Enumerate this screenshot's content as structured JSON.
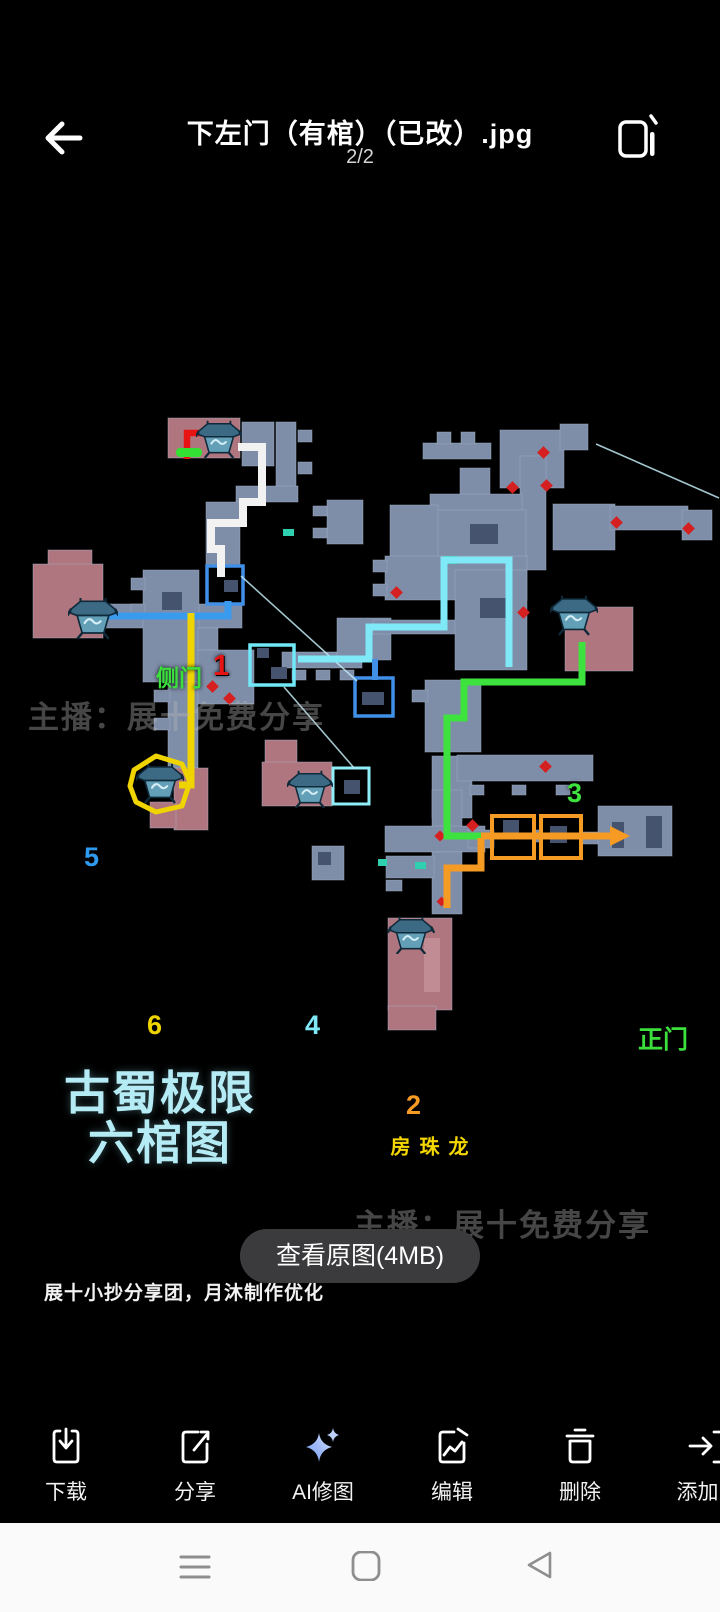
{
  "topbar": {
    "title": "下左门（有棺）（已改）.jpg",
    "page_indicator": "2/2"
  },
  "map": {
    "title_line1": "古蜀极限",
    "title_line2": "六棺图",
    "watermark": "主播：展十免费分享",
    "caption": "展十小抄分享团，月沐制作优化",
    "markers": {
      "m1": "1",
      "m2": "2",
      "m3": "3",
      "m4": "4",
      "m5": "5",
      "m6": "6"
    },
    "labels": {
      "side_door": "侧门",
      "main_door": "正门",
      "dragon_pearl_room": "龙珠房"
    },
    "colors": {
      "route1": "#f2f2f2",
      "route2": "#f59a23",
      "route3": "#3ee23e",
      "route4": "#7fe9f7",
      "route5": "#3a9bee",
      "route6": "#f0d400",
      "room_slate": "#7e8da8",
      "room_pink": "#b0767f",
      "enemy_dot": "#d42020"
    }
  },
  "view_original": {
    "label": "查看原图(4MB)"
  },
  "toolbar": {
    "items": [
      {
        "label": "下载",
        "icon": "download-icon"
      },
      {
        "label": "分享",
        "icon": "share-icon"
      },
      {
        "label": "AI修图",
        "icon": "ai-sparkle-icon"
      },
      {
        "label": "编辑",
        "icon": "edit-image-icon"
      },
      {
        "label": "删除",
        "icon": "trash-icon"
      },
      {
        "label": "添加到",
        "icon": "add-to-icon"
      }
    ]
  }
}
